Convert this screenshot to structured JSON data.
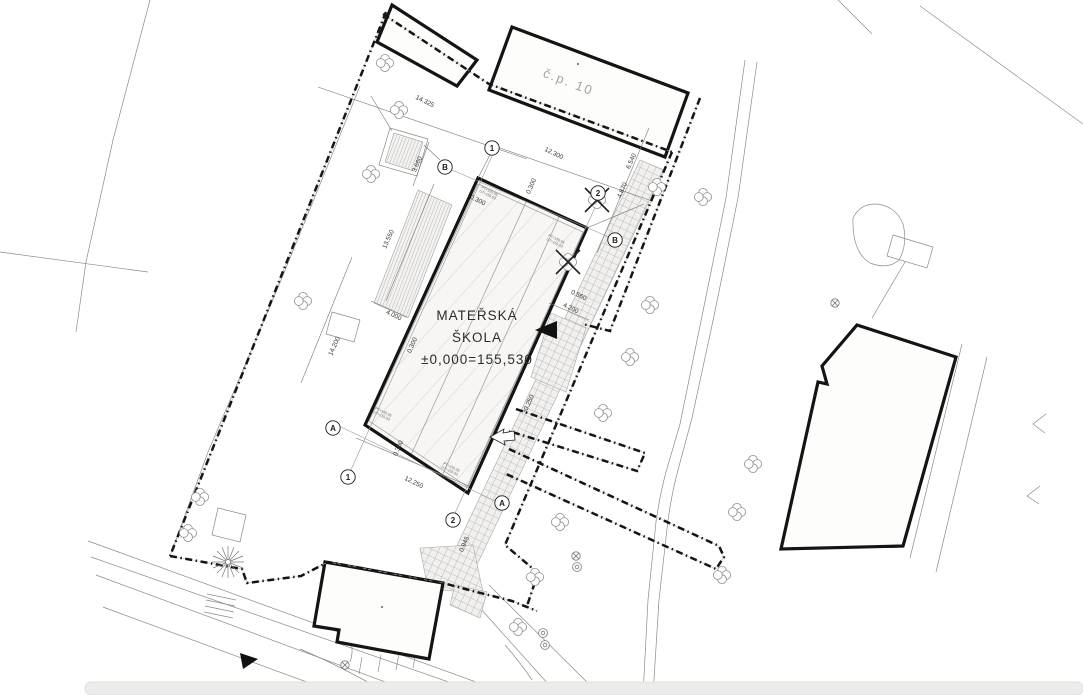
{
  "drawing": {
    "main_building": {
      "label_line1": "MATEŘSKÁ",
      "label_line2": "ŠKOLA",
      "label_line3": "±0,000=155,530"
    },
    "neighbor_label": "č.p. 10",
    "dimensions": [
      {
        "label": "14.325",
        "x": 424,
        "y": 103,
        "rot": 26
      },
      {
        "label": "12.300",
        "x": 553,
        "y": 155,
        "rot": 26
      },
      {
        "label": "13.550",
        "x": 390,
        "y": 240,
        "rot": -66
      },
      {
        "label": "14.200",
        "x": 336,
        "y": 347,
        "rot": -66
      },
      {
        "label": "12.250",
        "x": 413,
        "y": 484,
        "rot": 26
      },
      {
        "label": "4.000",
        "x": 393,
        "y": 317,
        "rot": 26
      },
      {
        "label": "3.660",
        "x": 419,
        "y": 165,
        "rot": -66
      },
      {
        "label": "0.300",
        "x": 477,
        "y": 202,
        "rot": 26
      },
      {
        "label": "0.300",
        "x": 533,
        "y": 187,
        "rot": -66
      },
      {
        "label": "0.300",
        "x": 414,
        "y": 346,
        "rot": -66
      },
      {
        "label": "0.300",
        "x": 400,
        "y": 449,
        "rot": -66
      },
      {
        "label": "0.560",
        "x": 578,
        "y": 297,
        "rot": 26
      },
      {
        "label": "4.200",
        "x": 570,
        "y": 310,
        "rot": 26
      },
      {
        "label": "6.540",
        "x": 633,
        "y": 162,
        "rot": -66
      },
      {
        "label": "4.870",
        "x": 624,
        "y": 191,
        "rot": -66
      },
      {
        "label": "30.250",
        "x": 530,
        "y": 405,
        "rot": -66
      },
      {
        "label": "0.945",
        "x": 466,
        "y": 545,
        "rot": -66
      }
    ],
    "grid_markers": [
      {
        "label": "1",
        "x": 492,
        "y": 148
      },
      {
        "label": "2",
        "x": 598,
        "y": 193
      },
      {
        "label": "B",
        "x": 445,
        "y": 167
      },
      {
        "label": "B",
        "x": 615,
        "y": 240
      },
      {
        "label": "A",
        "x": 333,
        "y": 428
      },
      {
        "label": "1",
        "x": 348,
        "y": 477
      },
      {
        "label": "2",
        "x": 453,
        "y": 520
      },
      {
        "label": "A",
        "x": 502,
        "y": 503
      }
    ],
    "corner_notes": [
      {
        "line1": "PT=155,05",
        "line2": "UT=155,53",
        "x": 489,
        "y": 192,
        "rot": 26
      },
      {
        "line1": "PT=155,05",
        "line2": "UT=155,53",
        "x": 556,
        "y": 240,
        "rot": 26
      },
      {
        "line1": "PT=155,05",
        "line2": "UT=155,53",
        "x": 383,
        "y": 413,
        "rot": 26
      },
      {
        "line1": "PT=155,05",
        "line2": "UT=155,53",
        "x": 451,
        "y": 468,
        "rot": 26
      }
    ],
    "colors": {
      "line": "#141414",
      "thin": "#8a8a8a",
      "hatch": "#c6c6c3",
      "label_grey": "#a3a3a1",
      "paper": "#ffffff"
    }
  }
}
